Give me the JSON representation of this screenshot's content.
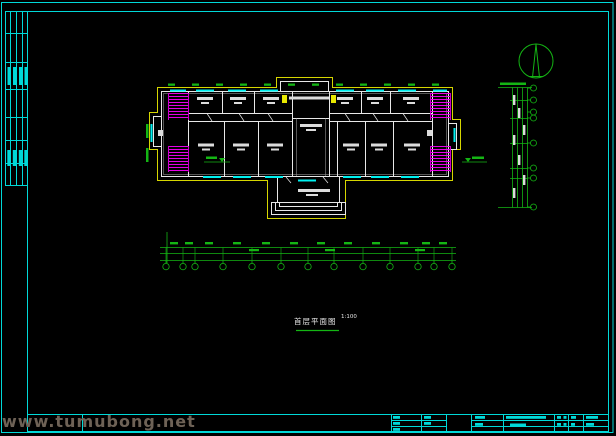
{
  "sheet": {
    "plan_title": "首层平面图",
    "plan_scale": "1:100"
  },
  "watermark": {
    "logo_text": "土木帮",
    "site_url": "www.tumubong.net"
  },
  "colors": {
    "background": "#000000",
    "frame": "#00d9d9",
    "walls": "#e8e8e8",
    "insulation_outline": "#d6d600",
    "stairs": "#e600e6",
    "windows": "#00f0f0",
    "dimensions": "#14b514",
    "watermark_text": "#3b2d20",
    "watermark_url": "#6e6256"
  }
}
